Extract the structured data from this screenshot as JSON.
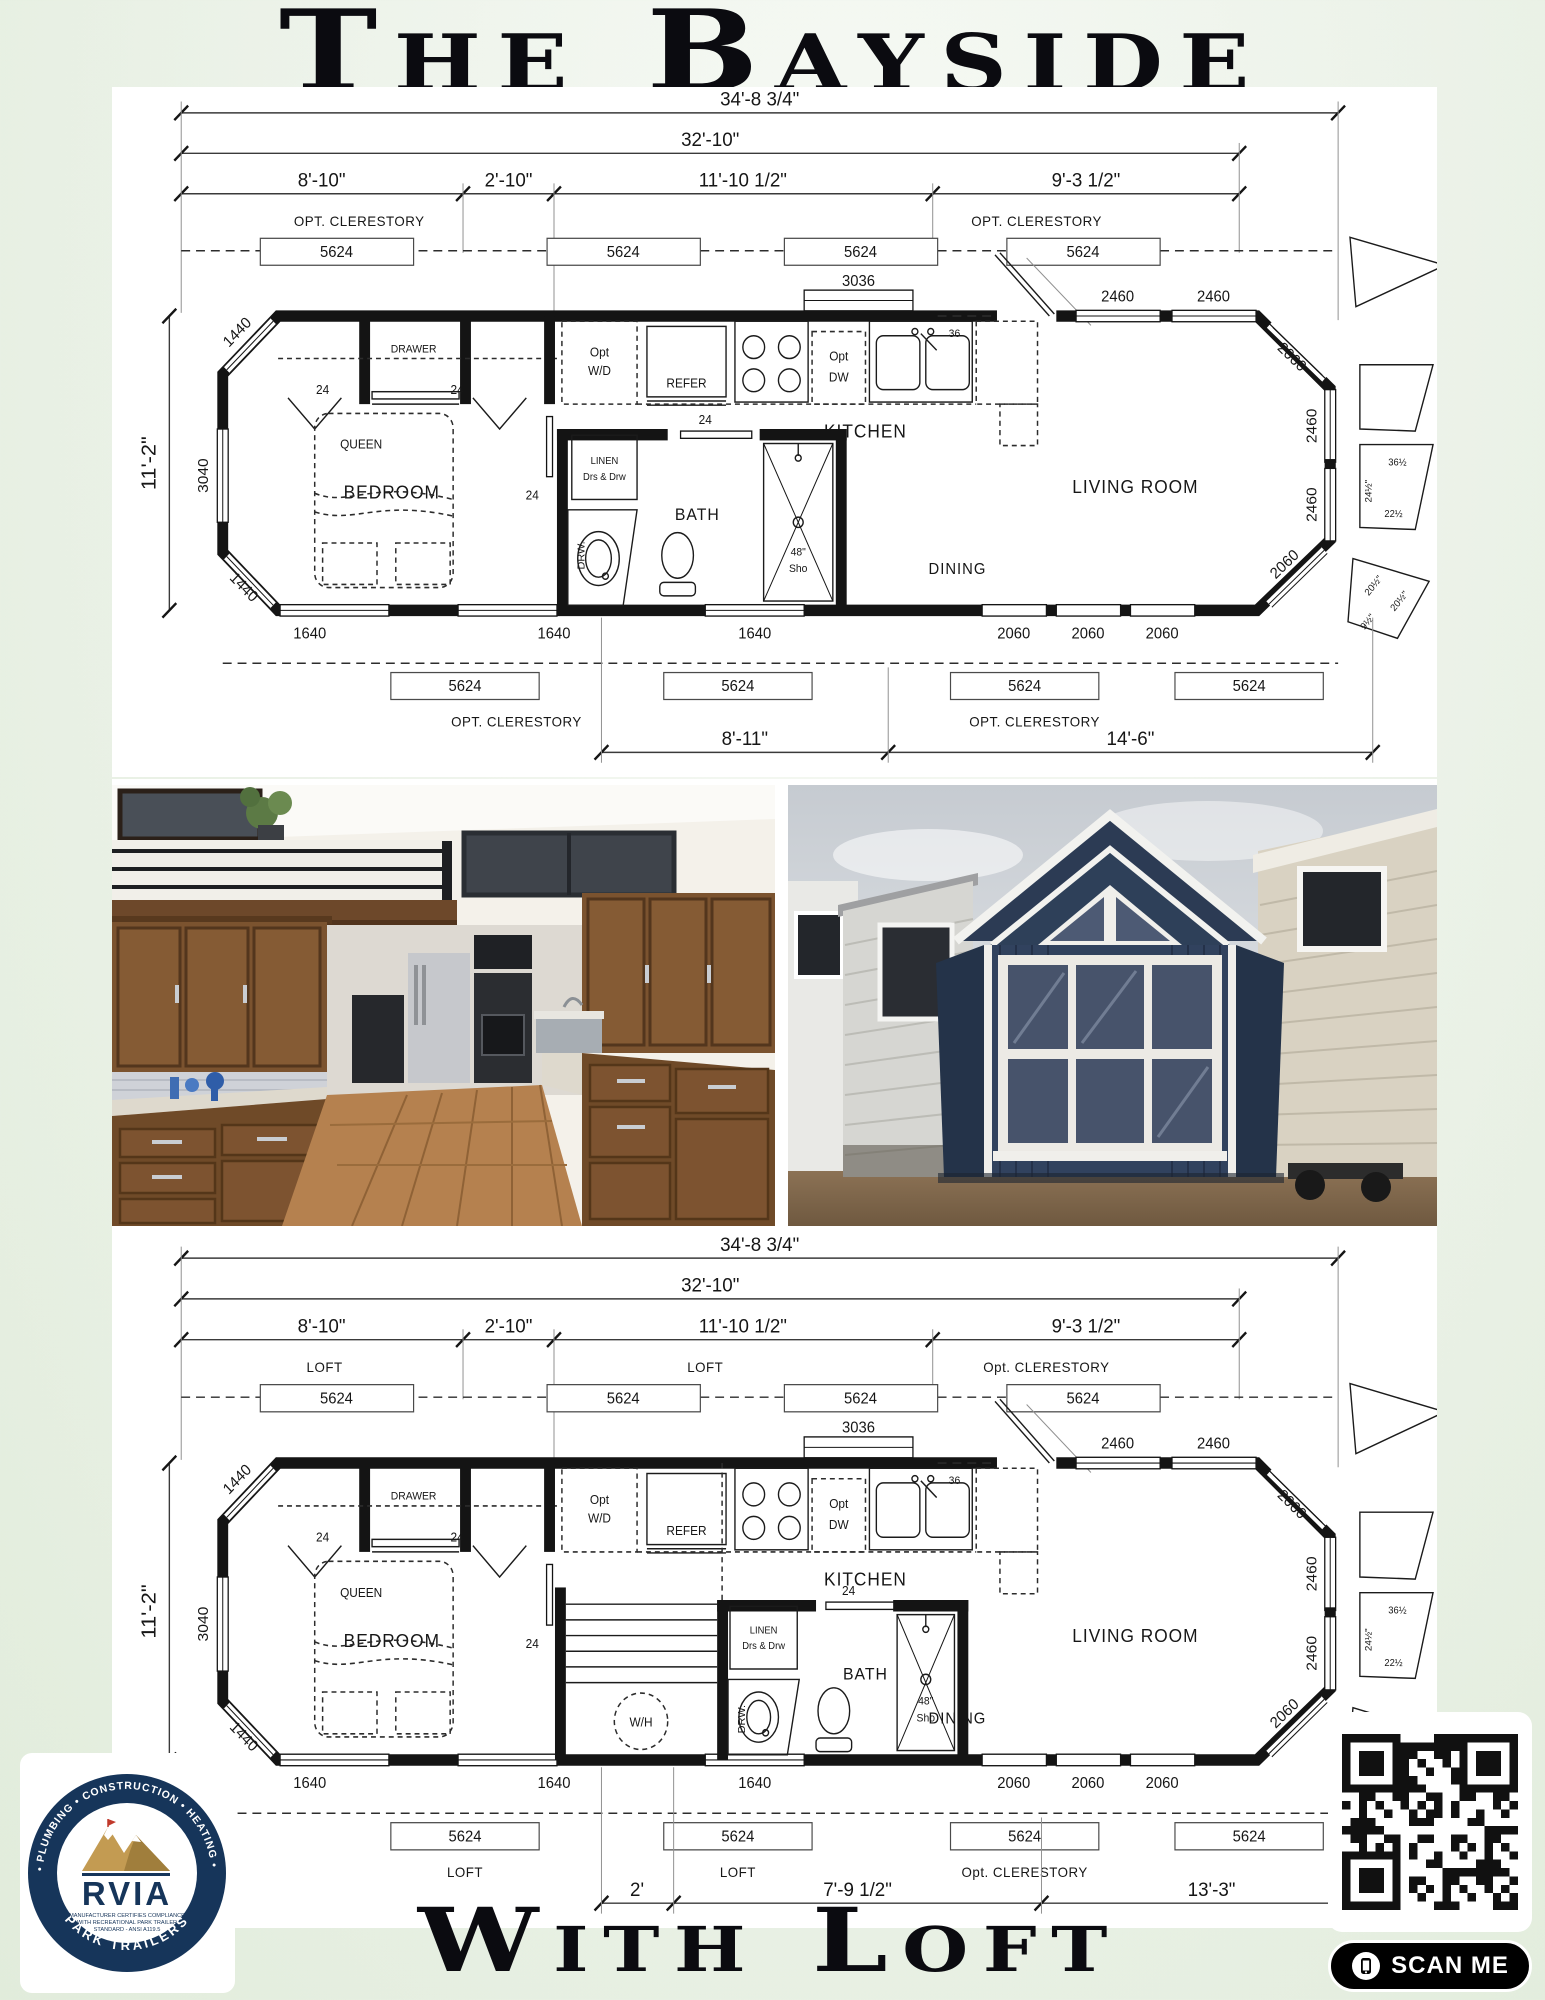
{
  "page": {
    "title": "The Bayside",
    "footer_title": "With Loft"
  },
  "plans": [
    {
      "dim_overall": "34'-8 3/4\"",
      "dim_inner": "32'-10\"",
      "seg": [
        "8'-10\"",
        "2'-10\"",
        "11'-10 1/2\"",
        "9'-3 1/2\""
      ],
      "zone_top": [
        "OPT. CLERESTORY",
        "OPT. CLERESTORY"
      ],
      "zone_bottom": [
        "OPT. CLERESTORY",
        "OPT. CLERESTORY"
      ],
      "dims_bottom": [
        "8'-11\"",
        "14'-6\""
      ],
      "side_dim": "11'-2\"",
      "w5624": "5624",
      "w3036": "3036",
      "w2460": "2460",
      "w2060": "2060",
      "w1640": "1640",
      "w1440": "1440",
      "w3040": "3040",
      "d24": "24",
      "d36": "36",
      "rooms": {
        "bedroom": "BEDROOM",
        "queen": "QUEEN",
        "bath": "BATH",
        "kitchen": "KITCHEN",
        "living": "LIVING ROOM",
        "dining": "DINING"
      },
      "fix": {
        "drawer": "DRAWER",
        "opt": "Opt",
        "wd": "W/D",
        "refer": "REFER",
        "dw": "DW",
        "linen1": "LINEN",
        "linen2": "Drs & Drw",
        "drw": "DRW.",
        "sho1": "48\"",
        "sho2": "Sho"
      },
      "notes": [
        "36½",
        "24½\"",
        "22½",
        "20½\"",
        "20½\"",
        "9½\""
      ]
    },
    {
      "dim_overall": "34'-8 3/4\"",
      "dim_inner": "32'-10\"",
      "seg": [
        "8'-10\"",
        "2'-10\"",
        "11'-10 1/2\"",
        "9'-3 1/2\""
      ],
      "zone_top": [
        "LOFT",
        "LOFT",
        "Opt. CLERESTORY"
      ],
      "zone_bottom": [
        "LOFT",
        "LOFT",
        "Opt. CLERESTORY"
      ],
      "dims_bottom": [
        "2'",
        "7'-9 1/2\"",
        "13'-3\""
      ],
      "side_dim": "11'-2\"",
      "w5624": "5624",
      "w3036": "3036",
      "w2460": "2460",
      "w2060": "2060",
      "w1640": "1640",
      "w1440": "1440",
      "w3040": "3040",
      "d24": "24",
      "d36": "36",
      "rooms": {
        "bedroom": "BEDROOM",
        "queen": "QUEEN",
        "bath": "BATH",
        "kitchen": "KITCHEN",
        "living": "LIVING ROOM",
        "dining": "DINING"
      },
      "fix": {
        "drawer": "DRAWER",
        "opt": "Opt",
        "wd": "W/D",
        "refer": "REFER",
        "dw": "DW",
        "linen1": "LINEN",
        "linen2": "Drs & Drw",
        "drw": "DRW.",
        "sho1": "48\"",
        "sho2": "Sho",
        "wh": "W/H"
      },
      "notes": [
        "36½",
        "24½\"",
        "22½",
        "20½\"",
        "20½\"",
        "9½\""
      ]
    }
  ],
  "rvia": {
    "ring_top": "ELECTRICAL • PLUMBING • CONSTRUCTION • HEATING • FIRE SAFETY",
    "name": "RVIA",
    "cert1": "MANUFACTURER CERTIFIES COMPLIANCE",
    "cert2": "WITH RECREATIONAL PARK TRAILER",
    "cert3": "STANDARD - ANSI A119.5",
    "ring_bottom": "PARK TRAILERS"
  },
  "scan": {
    "label": "SCAN ME"
  }
}
